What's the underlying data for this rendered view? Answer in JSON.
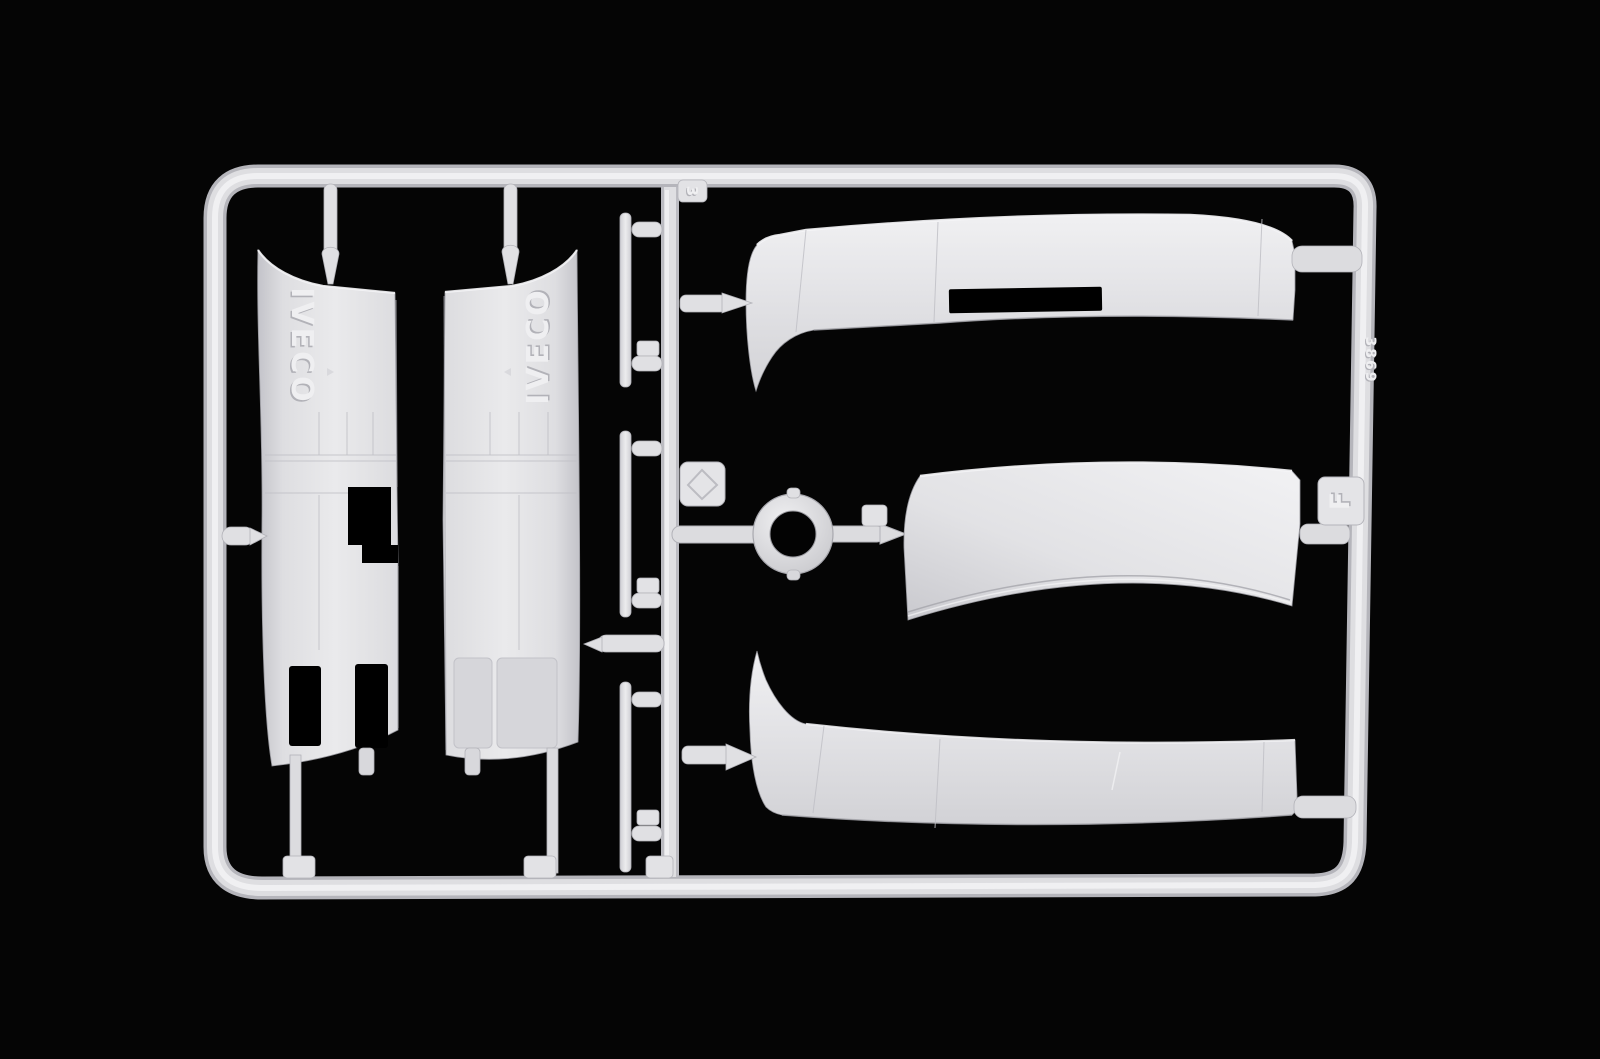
{
  "markings": {
    "left_panel_logo": "IVECO",
    "right_panel_logo": "IVECO",
    "runner_gate_number": "3",
    "sprue_letter": "F",
    "mold_code": "3869"
  },
  "colors": {
    "background": "#050505",
    "plastic_base": "#e2e2e5",
    "plastic_light": "#f3f3f5",
    "plastic_mid": "#d6d6da",
    "plastic_shadow": "#b9b9be",
    "outline": "#97979d",
    "cutout": "#000000"
  }
}
